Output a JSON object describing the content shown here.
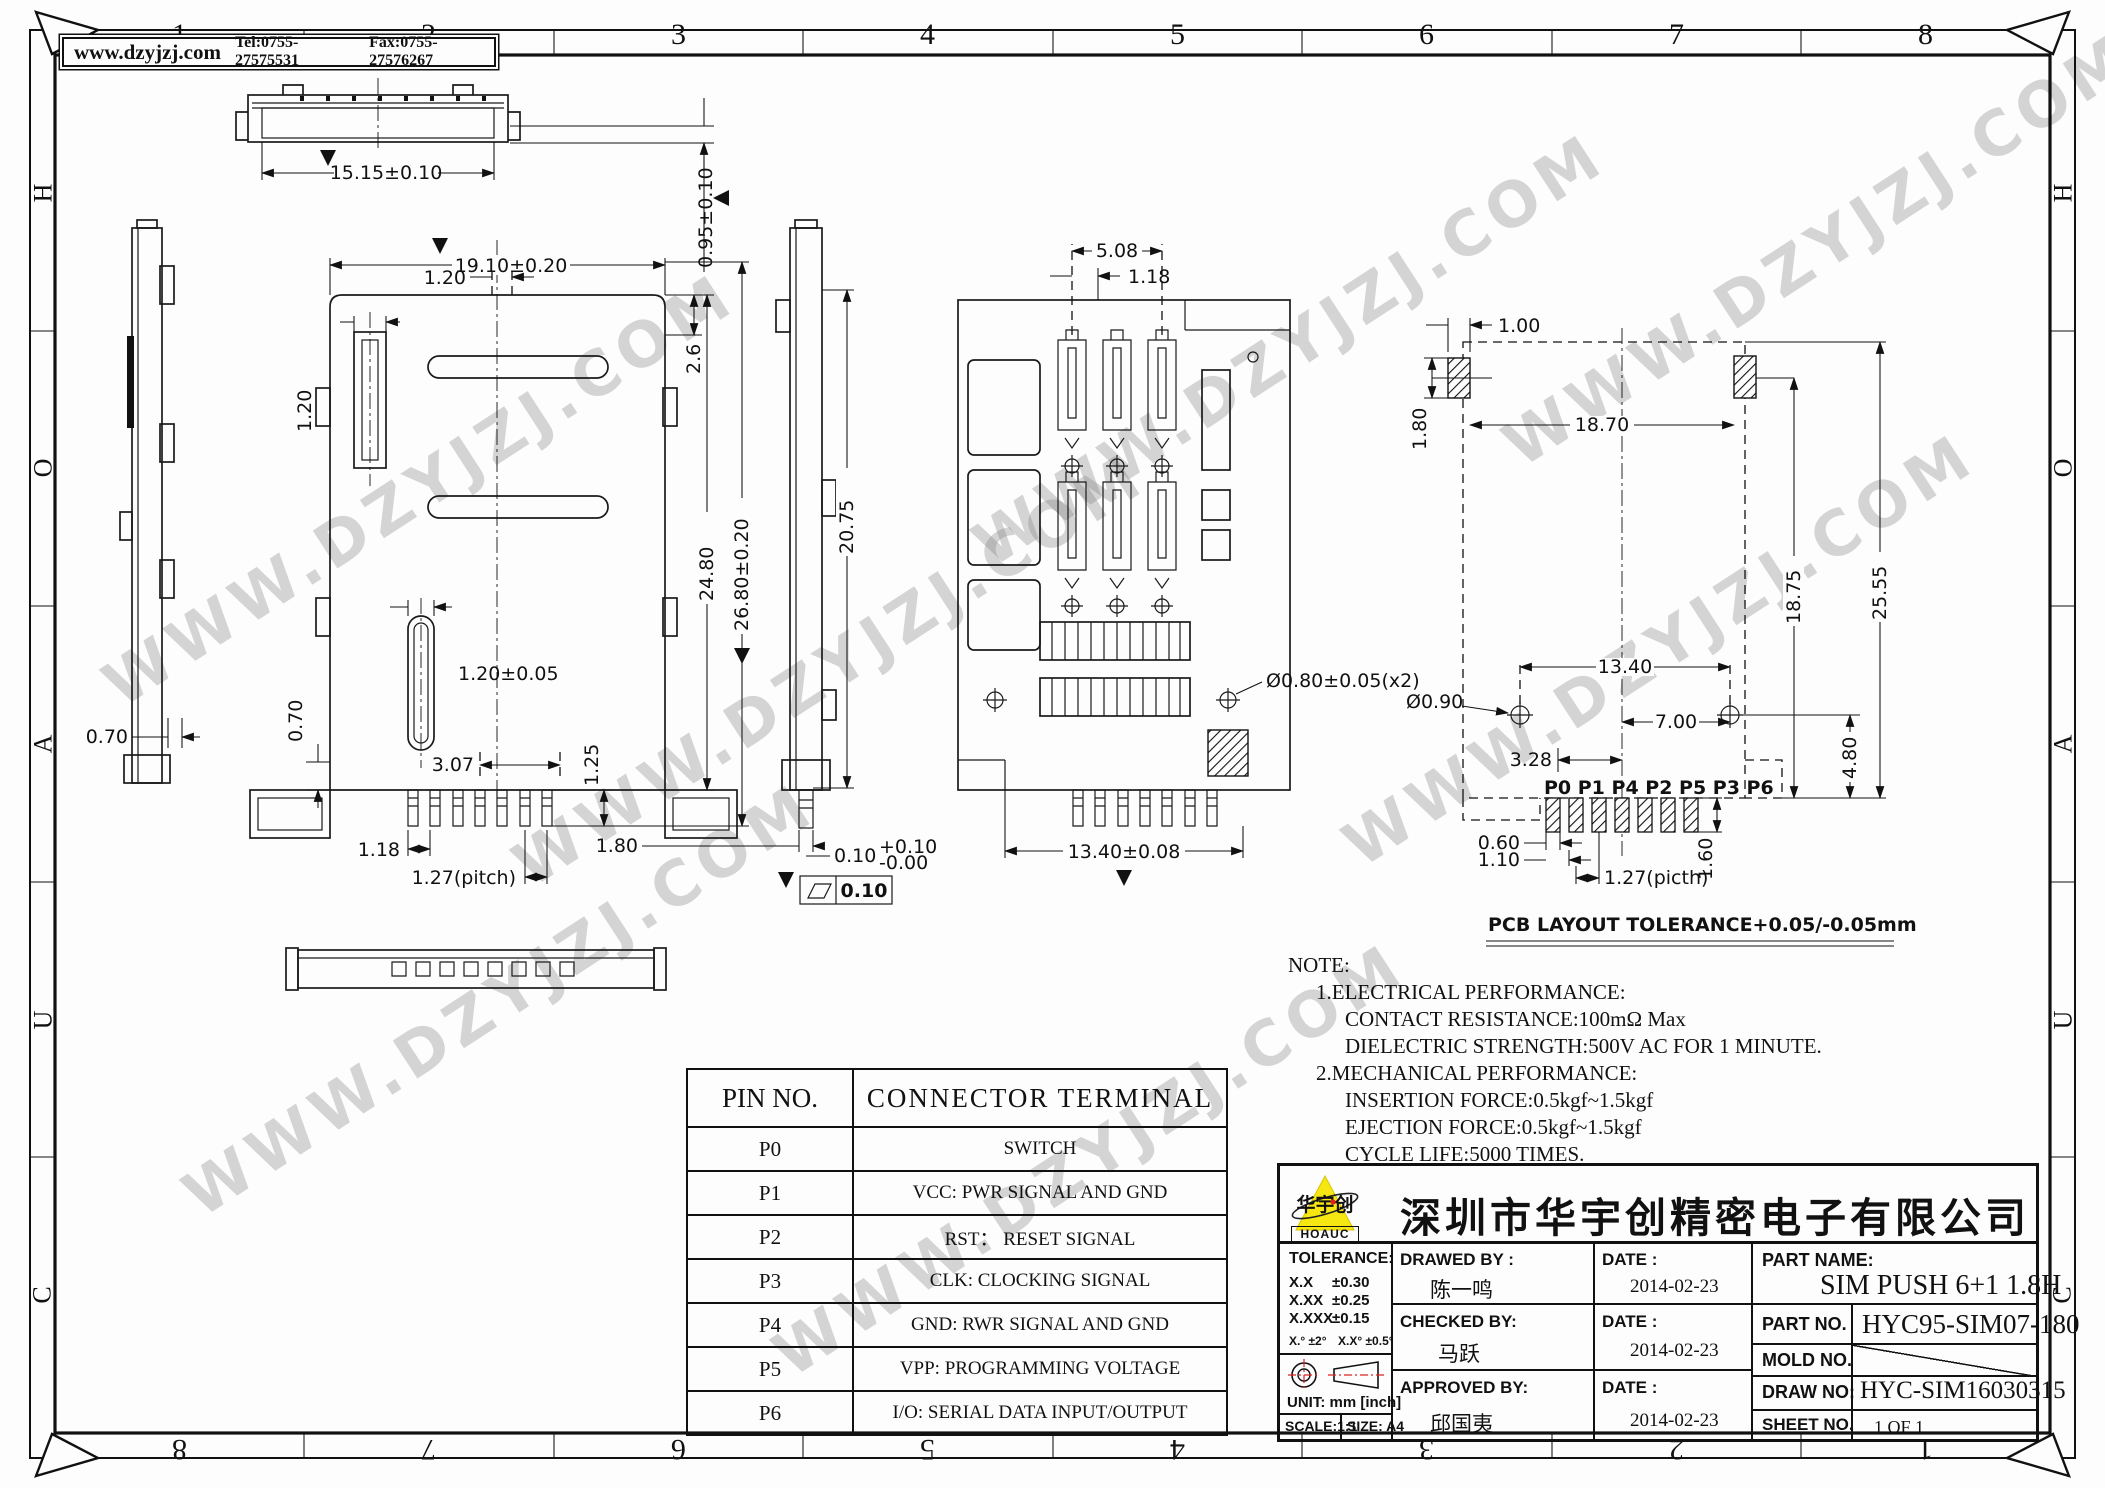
{
  "frame": {
    "website": "www.dzyjzj.com",
    "tel": "Tel:0755-27575531",
    "fax": "Fax:0755-27576267",
    "cols": [
      "1",
      "2",
      "3",
      "4",
      "5",
      "6",
      "7",
      "8"
    ],
    "rows": [
      "H",
      "O",
      "A",
      "U",
      "C"
    ]
  },
  "watermark": "WWW.DZYJZJ.COM",
  "dims": {
    "top_strip": {
      "width": "15.15±0.10",
      "height": "0.95±0.10"
    },
    "main": {
      "overall_width": "19.10±0.20",
      "slot": "1.20",
      "corner": "2.6",
      "tab": "1.20",
      "switch_slot": "1.20±0.05",
      "left_step": "0.70",
      "main_step": "0.70",
      "d307": "3.07",
      "pin_len": "1.25",
      "pin_gap": "1.18",
      "pitch": "1.27(pitch)",
      "body_len": "24.80",
      "overall_len": "26.80±0.20",
      "side_len": "20.75",
      "d180": "1.80",
      "d010": "0.10",
      "d010_up": "+0.10",
      "d010_dn": "-0.00",
      "flatness": "0.10"
    },
    "front": {
      "d508": "5.08",
      "d118": "1.18",
      "hole": "Ø0.80±0.05(x2)",
      "width": "13.40±0.08"
    },
    "pcb": {
      "d100": "1.00",
      "d180": "1.80",
      "d1870": "18.70",
      "d1875": "18.75",
      "d2555": "25.55",
      "d1340": "13.40",
      "d700": "7.00",
      "d090": "Ø0.90",
      "d480": "4.80",
      "d328": "3.28",
      "d060": "0.60",
      "d110": "1.10",
      "pitch": "1.27(picth)",
      "d160": "1.60",
      "pins": "P0 P1 P4 P2  P5 P3 P6",
      "tolerance": "PCB LAYOUT TOLERANCE+0.05/-0.05mm"
    }
  },
  "note": {
    "title": "NOTE:",
    "lines": [
      "1.ELECTRICAL PERFORMANCE:",
      "CONTACT RESISTANCE:100mΩ Max",
      "DIELECTRIC STRENGTH:500V AC FOR 1 MINUTE.",
      "2.MECHANICAL PERFORMANCE:",
      "INSERTION FORCE:0.5kgf~1.5kgf",
      "EJECTION FORCE:0.5kgf~1.5kgf",
      "CYCLE LIFE:5000 TIMES."
    ]
  },
  "pin_table": {
    "col1": "PIN NO.",
    "col2": "CONNECTOR  TERMINAL",
    "rows": [
      [
        "P0",
        "SWITCH"
      ],
      [
        "P1",
        "VCC: PWR SIGNAL AND GND"
      ],
      [
        "P2",
        "RST：  RESET SIGNAL"
      ],
      [
        "P3",
        "CLK: CLOCKING SIGNAL"
      ],
      [
        "P4",
        "GND: RWR SIGNAL AND GND"
      ],
      [
        "P5",
        "VPP: PROGRAMMING VOLTAGE"
      ],
      [
        "P6",
        "I/O: SERIAL DATA INPUT/OUTPUT"
      ]
    ]
  },
  "title_block": {
    "logo": {
      "brand": "HOAUC",
      "brand_cn": "华宇创"
    },
    "company": "深圳市华宇创精密电子有限公司",
    "tolerance": {
      "label": "TOLERANCE:",
      "r1l": "X.X",
      "r1v": "±0.30",
      "r2l": "X.XX",
      "r2v": "±0.25",
      "r3l": "X.XXX",
      "r3v": "±0.15",
      "angle1": "X.°  ±2°",
      "angle2": "X.X°  ±0.5°"
    },
    "unit": "UNIT:  mm  [inch]",
    "scale": "SCALE:1:1",
    "size": "SIZE:  A4",
    "drawed": {
      "label": "DRAWED BY :",
      "name": "陈一鸣",
      "date_label": "DATE :",
      "date": "2014-02-23"
    },
    "checked": {
      "label": "CHECKED BY:",
      "name": "马跃",
      "date_label": "DATE :",
      "date": "2014-02-23"
    },
    "approved": {
      "label": "APPROVED BY:",
      "name": "邱国夷",
      "date_label": "DATE :",
      "date": "2014-02-23"
    },
    "part_name": {
      "label": "PART NAME:",
      "value": "SIM PUSH 6+1 1.8H"
    },
    "part_no": {
      "label": "PART NO.",
      "value": "HYC95-SIM07-180"
    },
    "mold_no": {
      "label": "MOLD NO.",
      "value": ""
    },
    "draw_no": {
      "label": "DRAW NO:",
      "value": "HYC-SIM16030315"
    },
    "sheet_no": {
      "label": "SHEET NO.",
      "value": "1 OF 1"
    }
  }
}
